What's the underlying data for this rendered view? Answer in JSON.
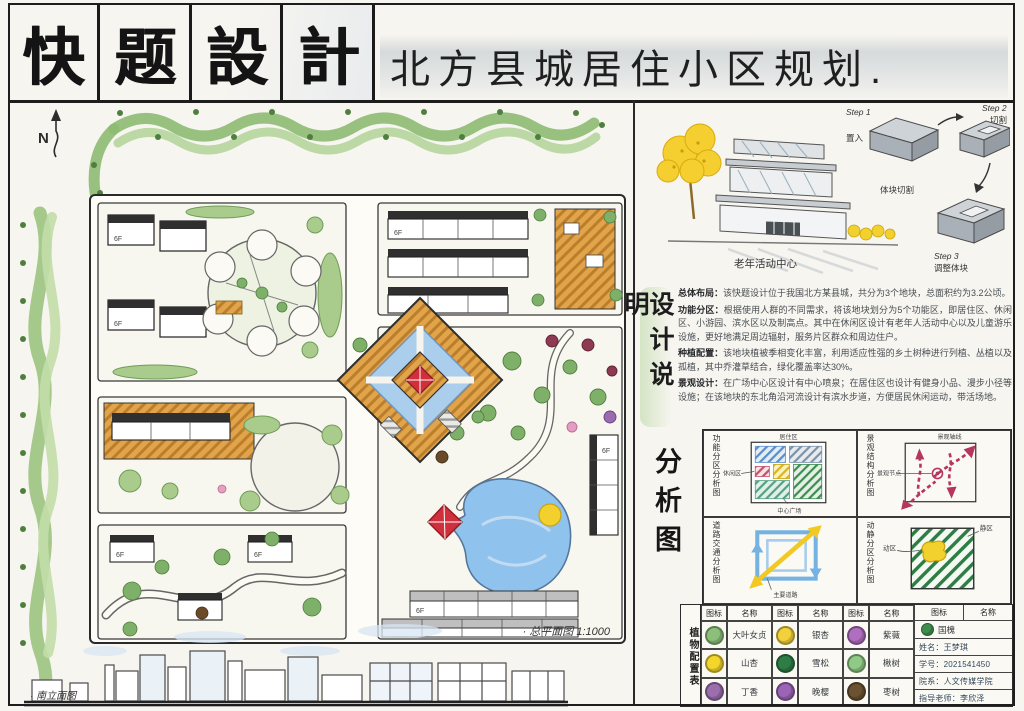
{
  "header": {
    "logo_chars": [
      "快",
      "题",
      "設",
      "計"
    ],
    "title": "北方县城居住小区规划."
  },
  "plan": {
    "north_label": "N",
    "caption": "· 总平面图 1:1000",
    "floor_label": "6F",
    "elevation_caption": "· 南立面图"
  },
  "perspective": {
    "building_caption": "老年活动中心",
    "massing_caption": "体块切割",
    "steps": [
      {
        "step": "Step 1",
        "action": "置入"
      },
      {
        "step": "Step 2",
        "action": "切割"
      },
      {
        "step": "Step 3",
        "action": "调整体块"
      }
    ]
  },
  "description": {
    "vertical_title": "设计说明",
    "paragraphs": [
      {
        "label": "总体布局：",
        "text": "该快题设计位于我国北方某县城，共分为3个地块，总面积约为3.2公顷。"
      },
      {
        "label": "功能分区：",
        "text": "根据使用人群的不同需求，将该地块划分为5个功能区，即居住区、休闲区、小游园、滨水区以及制高点。其中在休闲区设计有老年人活动中心以及儿童游乐设施，更好地满足周边辐射，服务片区群众和周边住户。"
      },
      {
        "label": "种植配置：",
        "text": "该地块植被季相变化丰富，利用适应性强的乡土树种进行列植、丛植以及孤植，其中乔灌草结合，绿化覆盖率达30%。"
      },
      {
        "label": "景观设计：",
        "text": "在广场中心区设计有中心喷泉；在居住区也设计有健身小品、漫步小径等设施；在该地块的东北角沿河流设计有滨水步道，方便居民休闲运动，带活场地。"
      }
    ]
  },
  "analysis": {
    "vertical_title": "分析图",
    "panels": [
      {
        "title": "功能分区分析图",
        "labels": [
          "居住区",
          "休闲区",
          "中心广场"
        ]
      },
      {
        "title": "景观结构分析图",
        "labels": [
          "景观轴线",
          "景观节点"
        ]
      },
      {
        "title": "道路交通分析图",
        "labels": [
          "主要道路"
        ]
      },
      {
        "title": "动静分区分析图",
        "labels": [
          "动区",
          "静区"
        ]
      }
    ]
  },
  "legend": {
    "vertical_title": "植物配置表",
    "icon_header": "图标",
    "name_header": "名称",
    "plants": [
      {
        "name": "大叶女贞",
        "color": "#8cc07a"
      },
      {
        "name": "银杏",
        "color": "#f2d23c"
      },
      {
        "name": "紫薇",
        "color": "#b06ec0"
      },
      {
        "name": "国槐",
        "color": "#3f8d4e"
      },
      {
        "name": "山杏",
        "color": "#f4d62a"
      },
      {
        "name": "雪松",
        "color": "#2f7d46"
      },
      {
        "name": "楸树",
        "color": "#8fca86"
      },
      {
        "name": "丁香",
        "color": "#9b6fae"
      },
      {
        "name": "晚樱",
        "color": "#9c64b5"
      },
      {
        "name": "枣树",
        "color": "#6b5230"
      }
    ]
  },
  "info": {
    "rows": [
      "姓名：王梦琪",
      "学号：2021541450",
      "院系：人文传媒学院",
      "指导老师：李欣泽"
    ]
  }
}
